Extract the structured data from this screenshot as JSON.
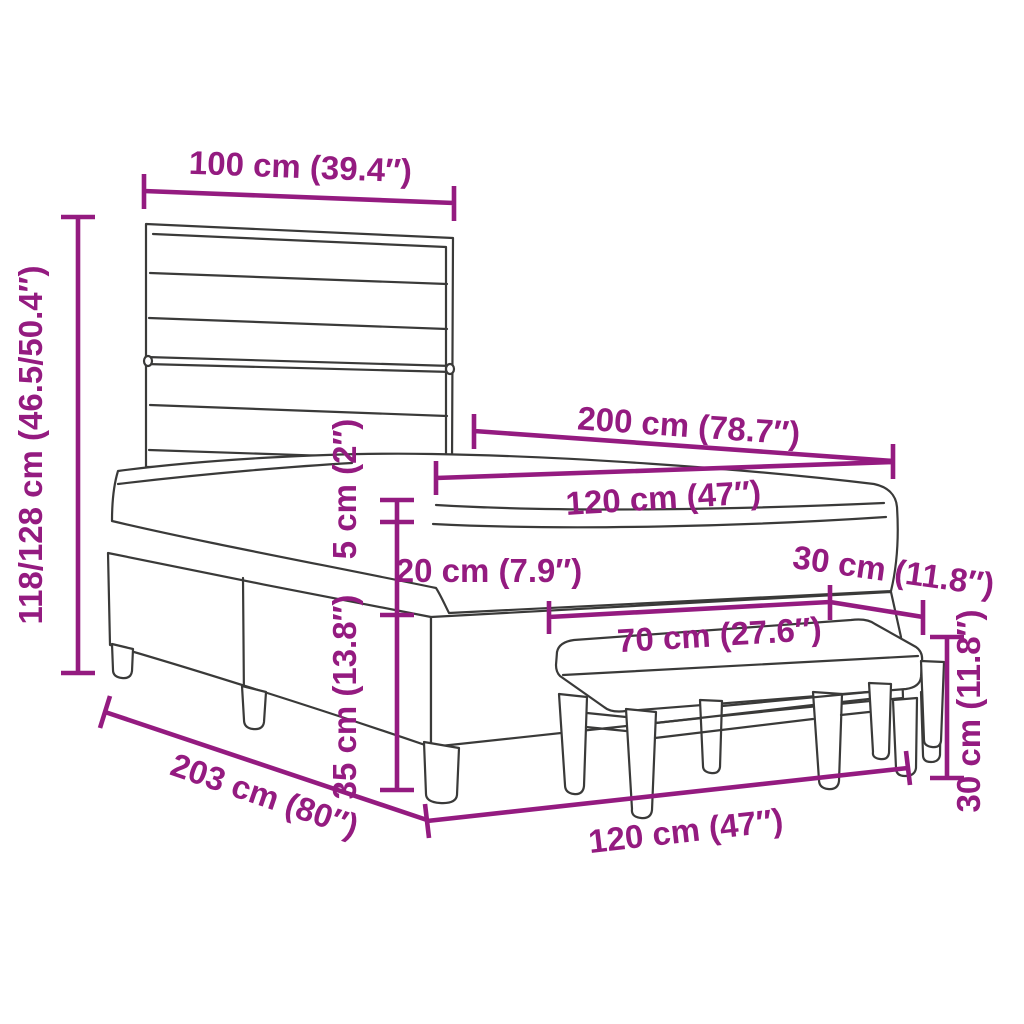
{
  "diagram": {
    "type": "product-dimension-diagram",
    "colors": {
      "dimension": "#941b80",
      "outline": "#3a3a39",
      "background": "#ffffff"
    },
    "dimensions": [
      {
        "id": "headboard-width",
        "label": "100 cm (39.4″)"
      },
      {
        "id": "total-height",
        "label": "118/128 cm (46.5/50.4″)"
      },
      {
        "id": "mattress-length",
        "label": "200 cm (78.7″)"
      },
      {
        "id": "mattress-width",
        "label": "120 cm (47″)"
      },
      {
        "id": "topper-height",
        "label": "5 cm (2″)"
      },
      {
        "id": "mattress-height",
        "label": "20 cm (7.9″)"
      },
      {
        "id": "bench-depth",
        "label": "30 cm (11.8″)"
      },
      {
        "id": "bench-length",
        "label": "70 cm (27.6″)"
      },
      {
        "id": "base-height",
        "label": "35 cm (13.8″)"
      },
      {
        "id": "bed-length",
        "label": "203 cm (80″)"
      },
      {
        "id": "bed-width",
        "label": "120 cm (47″)"
      },
      {
        "id": "bench-height",
        "label": "30 cm (11.8″)"
      }
    ]
  }
}
